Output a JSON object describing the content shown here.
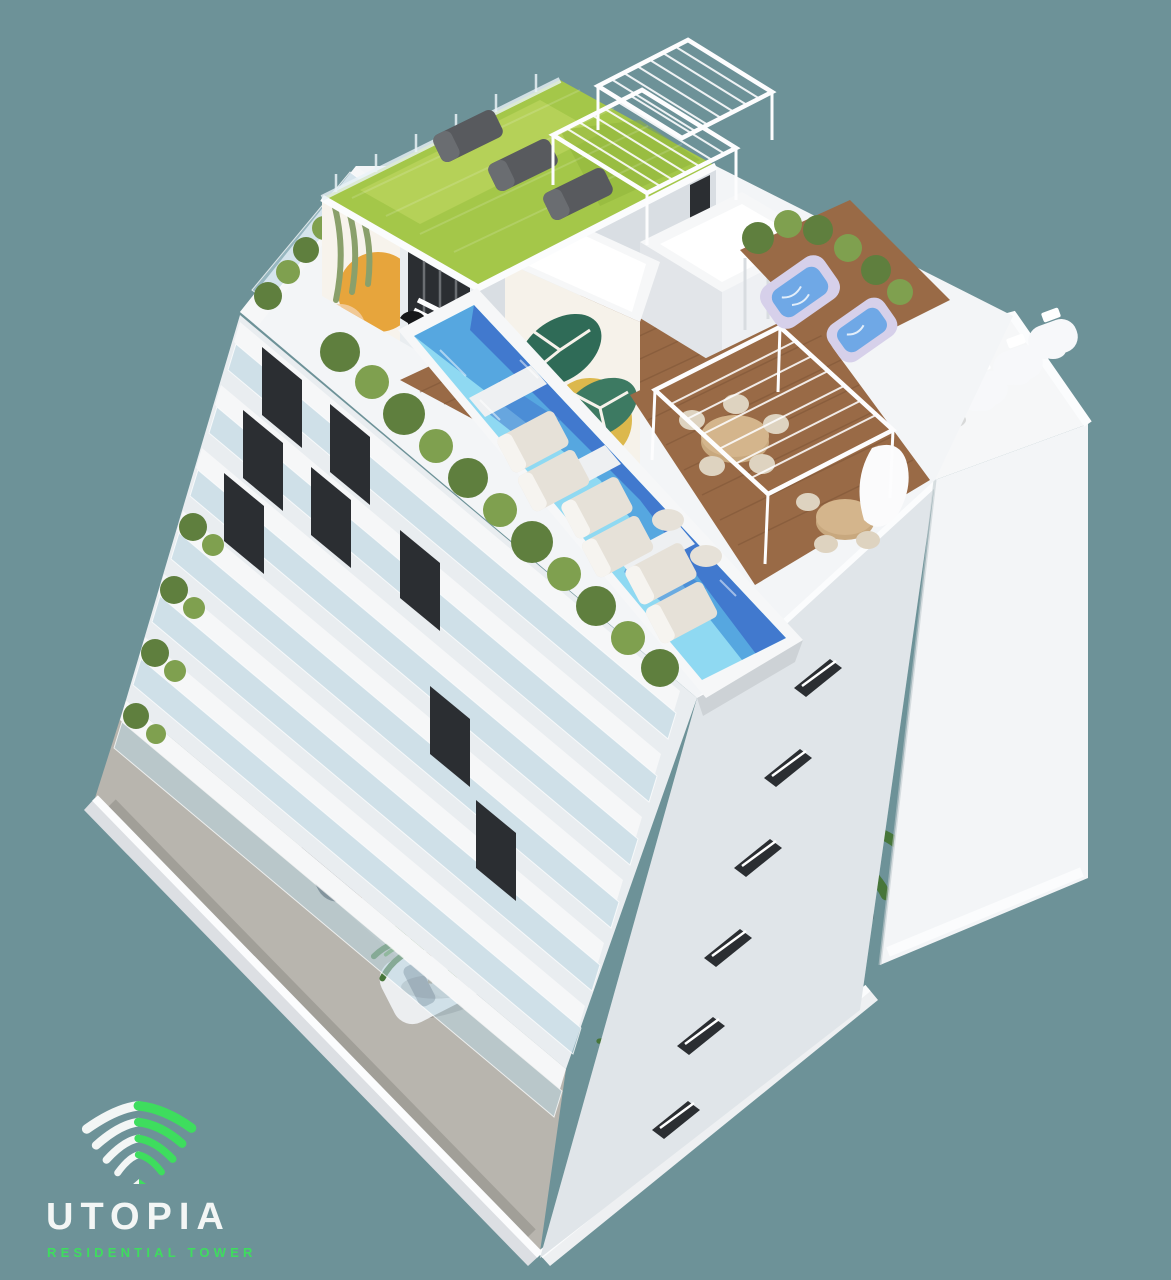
{
  "branding": {
    "name": "UTOPIA",
    "tagline": "RESIDENTIAL TOWER"
  },
  "palette": {
    "background": "#6D9298",
    "logo_green": "#3EDD5E",
    "text_white": "#F3F6F5",
    "building_white": "#F3F5F7",
    "building_light": "#E9EDF0",
    "building_shade": "#D9DEE3",
    "marble_white": "#F6F7F8",
    "glass_blue": "#BAD6E2",
    "window_dark": "#2B2E32",
    "pool_light": "#8FD9F2",
    "pool_mid": "#56A7E0",
    "pool_deep": "#3F74CC",
    "grass_green": "#A4C749",
    "grass_light": "#BCD65F",
    "hedge_green": "#5F7F3E",
    "hedge_light": "#7FA04F",
    "palm_green": "#47763A",
    "wood_brown": "#996A46",
    "wood_dark": "#7C5436",
    "sand_tan": "#C8A87E",
    "chair_cream": "#DED3C0",
    "concrete": "#B8B5AE",
    "car_dark": "#41454A",
    "car_white": "#ECEEF0",
    "tub_lavender": "#D6D0EA",
    "tub_water": "#6FA8E6",
    "mural_orange": "#E7A53C",
    "mural_yellow": "#D9B13B",
    "mural_leaf": "#2F6B57",
    "mural_palm": "#8AA06B",
    "lounger_gray": "#585A5E",
    "cushion_warm": "#E6E1D8"
  }
}
